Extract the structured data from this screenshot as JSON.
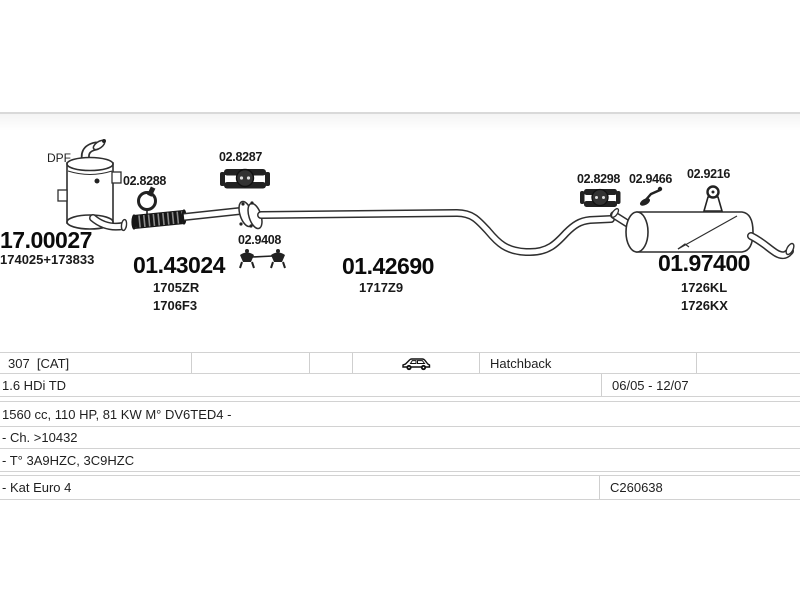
{
  "diagram": {
    "dpf_label": "DPF",
    "parts": {
      "dpf": {
        "number": "17.00027",
        "oe": "174025+173833"
      },
      "front_flex_pipe": {
        "number": "01.43024",
        "oe1": "1705ZR",
        "oe2": "1706F3"
      },
      "centre_pipe": {
        "number": "01.42690",
        "oe1": "1717Z9"
      },
      "rear_silencer": {
        "number": "01.97400",
        "oe1": "1726KL",
        "oe2": "1726KX"
      }
    },
    "fittings": {
      "clamp_a": "02.8288",
      "clamp_b": "02.8287",
      "hanger_pair": "02.9408",
      "clamp_c": "02.8298",
      "hanger_small": "02.9466",
      "mount": "02.9216"
    }
  },
  "table": {
    "model": {
      "name": "307  [CAT]",
      "body_type": "Hatchback"
    },
    "engine": {
      "name": "1.6 HDi TD",
      "date_range": "06/05 - 12/07"
    },
    "spec": "1560 cc, 110 HP, 81 KW M° DV6TED4 -",
    "chassis": "- Ch. >10432",
    "type_codes": "- T° 3A9HZC, 3C9HZC",
    "emission": {
      "name": "- Kat Euro 4",
      "code": "C260638"
    }
  },
  "colors": {
    "line": "#2f2f2f",
    "table_border": "#d2d2d2"
  }
}
